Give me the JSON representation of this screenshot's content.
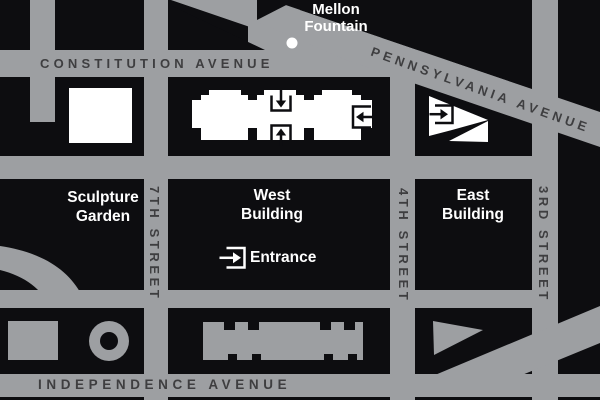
{
  "streets": {
    "constitution_avenue": "CONSTITUTION AVENUE",
    "pennsylvania_avenue": "PENNSYLVANIA AVENUE",
    "independence_avenue": "INDEPENDENCE AVENUE",
    "seventh_street": "7TH STREET",
    "fourth_street": "4TH STREET",
    "third_street": "3RD STREET"
  },
  "places": {
    "mellon_line1": "Mellon",
    "mellon_line2": "Fountain",
    "sculpture_line1": "Sculpture",
    "sculpture_line2": "Garden",
    "west_line1": "West",
    "west_line2": "Building",
    "east_line1": "East",
    "east_line2": "Building",
    "entrance": "Entrance"
  },
  "icons": {
    "constitution_side_entrance": "arrow-down-into-bracket",
    "madison_side_entrance": "arrow-up-into-bracket",
    "fourth_street_side_entrance": "arrow-left-into-bracket",
    "east_building_entrance": "arrow-right-into-bracket",
    "main_entrance": "arrow-right-into-bracket",
    "mellon_fountain_marker": "white-dot"
  },
  "colors": {
    "street_gray": "#9D9FA2",
    "block_black": "#0D0D10",
    "building_white": "#FFFFFF",
    "street_label_dark": "#3E3E40",
    "place_label_white": "#FFFFFF"
  }
}
